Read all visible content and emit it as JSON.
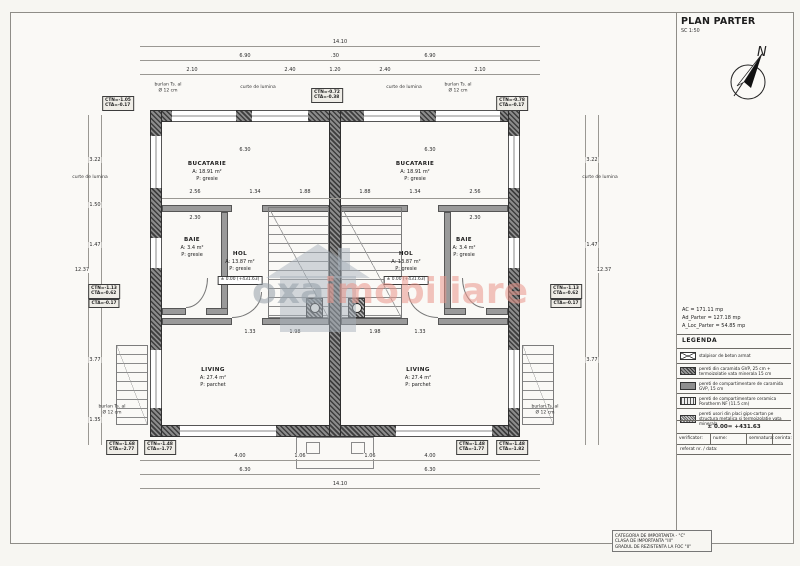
{
  "titleblock": {
    "title": "PLAN PARTER",
    "scale": "SC 1:50",
    "stats": [
      "AC = 171.11 mp",
      "Ad_Parter = 127.18 mp",
      "A_Loc_Parter = 54.85 mp"
    ],
    "legend_label": "LEGENDA",
    "legend": [
      {
        "swatch": "rc-column-hatch-icon",
        "desc": "stalpisor de beton armat"
      },
      {
        "swatch": "brick-wall-hatch-icon",
        "desc": "pereti din caramida GVP, 25 cm + termoizolatie vata minerala 15 cm"
      },
      {
        "swatch": "partition-wall-hatch-icon",
        "desc": "pereti de compartimentare de caramida GVP, 15 cm"
      },
      {
        "swatch": "porotherm-hatch-icon",
        "desc": "pereti de compartimentare ceramica Porotherm NF (11.5 cm)"
      },
      {
        "swatch": "drywall-hatch-icon",
        "desc": "pereti usori din placi gips-carton pe structura metalica si termoizolatie vata minerala"
      }
    ],
    "level_reference": "± 0.00= +431.63",
    "table_headers": [
      "verificator:",
      "nume:",
      "semnatura:",
      "cerinta:"
    ],
    "referat": "referat nr. / data:"
  },
  "notes_box": [
    "CATEGORIA DE IMPORTANTA - \"C\"",
    "CLASA DE IMPORTANTA \"III\"",
    "GRADUL DE REZISTENTA LA FOC \"II\""
  ],
  "watermark": {
    "gray": "oxa",
    "accent": "imobiliare",
    "accent_color": "#e9968b"
  },
  "plan": {
    "ext_walls": [
      [
        150,
        110,
        370,
        12
      ],
      [
        150,
        425,
        370,
        12
      ],
      [
        150,
        110,
        12,
        327
      ],
      [
        508,
        110,
        12,
        327
      ],
      [
        329,
        110,
        12,
        327
      ]
    ],
    "int_walls": [
      [
        162,
        205,
        70,
        7
      ],
      [
        262,
        205,
        67,
        7
      ],
      [
        341,
        205,
        67,
        7
      ],
      [
        438,
        205,
        70,
        7
      ],
      [
        221,
        212,
        7,
        103
      ],
      [
        162,
        308,
        24,
        7
      ],
      [
        206,
        308,
        22,
        7
      ],
      [
        444,
        212,
        7,
        103
      ],
      [
        444,
        308,
        22,
        7
      ],
      [
        486,
        308,
        22,
        7
      ],
      [
        162,
        318,
        70,
        7
      ],
      [
        262,
        318,
        67,
        7
      ],
      [
        341,
        318,
        67,
        7
      ],
      [
        438,
        318,
        70,
        7
      ]
    ],
    "windows_h": [
      [
        172,
        110,
        64,
        12
      ],
      [
        252,
        110,
        56,
        12
      ],
      [
        364,
        110,
        56,
        12
      ],
      [
        436,
        110,
        64,
        12
      ],
      [
        180,
        425,
        96,
        12
      ],
      [
        396,
        425,
        96,
        12
      ]
    ],
    "windows_v": [
      [
        150,
        136,
        12,
        52
      ],
      [
        150,
        238,
        12,
        30
      ],
      [
        150,
        350,
        12,
        58
      ],
      [
        508,
        136,
        12,
        52
      ],
      [
        508,
        238,
        12,
        30
      ],
      [
        508,
        350,
        12,
        58
      ]
    ],
    "stairs": [
      [
        268,
        207,
        61,
        111
      ],
      [
        341,
        207,
        61,
        111
      ]
    ],
    "ext_stairs": [
      [
        116,
        345,
        32,
        80
      ],
      [
        522,
        345,
        32,
        80
      ]
    ],
    "posts": [
      [
        306,
        298,
        17,
        20
      ],
      [
        348,
        298,
        17,
        20
      ]
    ],
    "boxes": [
      [
        296,
        437,
        78,
        32
      ],
      [
        306,
        442,
        14,
        12
      ],
      [
        351,
        442,
        14,
        12
      ]
    ],
    "arcs": [
      [
        186,
        278,
        22,
        30,
        "br"
      ],
      [
        462,
        278,
        22,
        30,
        "bl"
      ],
      [
        232,
        292,
        30,
        26,
        "br"
      ],
      [
        408,
        292,
        30,
        26,
        "bl"
      ]
    ],
    "dim_lines": [
      [
        140,
        46,
        400,
        1
      ],
      [
        140,
        60,
        400,
        1
      ],
      [
        140,
        74,
        400,
        1
      ],
      [
        140,
        460,
        400,
        1
      ],
      [
        140,
        474,
        400,
        1
      ],
      [
        140,
        488,
        400,
        1
      ],
      [
        88,
        115,
        1,
        330
      ],
      [
        101,
        115,
        1,
        330
      ],
      [
        585,
        115,
        1,
        330
      ],
      [
        598,
        115,
        1,
        330
      ],
      [
        162,
        198,
        346,
        1
      ]
    ],
    "dims": [
      [
        "14.10",
        340,
        42,
        0
      ],
      [
        "6.90",
        245,
        56,
        0
      ],
      [
        ".30",
        335,
        56,
        0
      ],
      [
        "6.90",
        430,
        56,
        0
      ],
      [
        "2.10",
        192,
        70,
        0
      ],
      [
        "2.40",
        290,
        70,
        0
      ],
      [
        "1.20",
        335,
        70,
        0
      ],
      [
        "2.40",
        385,
        70,
        0
      ],
      [
        "2.10",
        480,
        70,
        0
      ],
      [
        "6.30",
        245,
        150,
        0
      ],
      [
        "6.30",
        430,
        150,
        0
      ],
      [
        "2.56",
        195,
        192,
        0
      ],
      [
        "1.34",
        255,
        192,
        0
      ],
      [
        "1.88",
        305,
        192,
        0
      ],
      [
        "1.88",
        365,
        192,
        0
      ],
      [
        "1.34",
        415,
        192,
        0
      ],
      [
        "2.56",
        475,
        192,
        0
      ],
      [
        "2.30",
        195,
        218,
        0
      ],
      [
        "2.30",
        475,
        218,
        0
      ],
      [
        "1.33",
        250,
        332,
        0
      ],
      [
        "1.98",
        295,
        332,
        0
      ],
      [
        "1.98",
        375,
        332,
        0
      ],
      [
        "1.33",
        420,
        332,
        0
      ],
      [
        "4.00",
        240,
        456,
        0
      ],
      [
        "1.06",
        300,
        456,
        0
      ],
      [
        "1.06",
        370,
        456,
        0
      ],
      [
        "4.00",
        430,
        456,
        0
      ],
      [
        "6.30",
        245,
        470,
        0
      ],
      [
        "6.30",
        430,
        470,
        0
      ],
      [
        "14.10",
        340,
        484,
        0
      ],
      [
        "12.37",
        82,
        270,
        -90
      ],
      [
        "3.22",
        95,
        160,
        -90
      ],
      [
        "1.50",
        95,
        205,
        -90
      ],
      [
        "1.47",
        95,
        245,
        -90
      ],
      [
        "3.77",
        95,
        360,
        -90
      ],
      [
        "1.35",
        95,
        420,
        -90
      ],
      [
        "12.37",
        604,
        270,
        90
      ],
      [
        "3.22",
        592,
        160,
        90
      ],
      [
        "1.47",
        592,
        245,
        90
      ],
      [
        "3.77",
        592,
        360,
        90
      ]
    ],
    "rooms": [
      {
        "name": "BUCATARIE",
        "area": "A: 18.91 m²",
        "floor": "P:  gresie",
        "x": 207,
        "y": 160
      },
      {
        "name": "BUCATARIE",
        "area": "A: 18.91 m²",
        "floor": "P:  gresie",
        "x": 415,
        "y": 160
      },
      {
        "name": "BAIE",
        "area": "A: 3.4 m²",
        "floor": "P: gresie",
        "x": 192,
        "y": 236
      },
      {
        "name": "BAIE",
        "area": "A: 3.4 m²",
        "floor": "P: gresie",
        "x": 464,
        "y": 236
      },
      {
        "name": "HOL",
        "area": "A: 13.87 m²",
        "floor": "P:  gresie",
        "x": 240,
        "y": 250,
        "level": "± 0.00 (+431.63)"
      },
      {
        "name": "HOL",
        "area": "A: 13.87 m²",
        "floor": "P:  gresie",
        "x": 406,
        "y": 250,
        "level": "± 0.00 (+431.63)"
      },
      {
        "name": "LIVING",
        "area": "A: 27.4 m²",
        "floor": "P:  parchet",
        "x": 213,
        "y": 366
      },
      {
        "name": "LIVING",
        "area": "A: 27.4 m²",
        "floor": "P:  parchet",
        "x": 418,
        "y": 366
      }
    ],
    "marks": [
      {
        "x": 118,
        "y": 96,
        "lines": [
          "CTN=-1.05",
          "CTA=-0.17"
        ]
      },
      {
        "x": 327,
        "y": 88,
        "lines": [
          "CTN=-0.72",
          "CTA=-0.38"
        ]
      },
      {
        "x": 512,
        "y": 96,
        "lines": [
          "CTN=-0.78",
          "CTA=-0.17"
        ]
      },
      {
        "x": 104,
        "y": 284,
        "lines": [
          "CTN=-1.13",
          "CTA=-0.62"
        ]
      },
      {
        "x": 104,
        "y": 299,
        "lines": [
          "CTA=-0.17"
        ]
      },
      {
        "x": 566,
        "y": 284,
        "lines": [
          "CTN=-1.13",
          "CTA=-0.62"
        ]
      },
      {
        "x": 566,
        "y": 299,
        "lines": [
          "CTA=-0.17"
        ]
      },
      {
        "x": 122,
        "y": 440,
        "lines": [
          "CTN=-1.68",
          "CTA=-2.77"
        ]
      },
      {
        "x": 160,
        "y": 440,
        "lines": [
          "CTN=-1.48",
          "CTA=-1.77"
        ]
      },
      {
        "x": 472,
        "y": 440,
        "lines": [
          "CTN=-1.48",
          "CTA=-1.77"
        ]
      },
      {
        "x": 512,
        "y": 440,
        "lines": [
          "CTN=-1.48",
          "CTA=-1.82"
        ]
      }
    ],
    "notes": [
      {
        "t": "burlan Ts. al\nØ 12 cm",
        "x": 168,
        "y": 88
      },
      {
        "t": "burlan Ts. al\nØ 12 cm",
        "x": 458,
        "y": 88
      },
      {
        "t": "burlan Ts. al\nØ 12 cm",
        "x": 112,
        "y": 410
      },
      {
        "t": "burlan Ts. al\nØ 12 cm",
        "x": 545,
        "y": 410
      },
      {
        "t": "curte de lumina",
        "x": 258,
        "y": 88
      },
      {
        "t": "curte de lumina",
        "x": 404,
        "y": 88
      },
      {
        "t": "curte de lumina",
        "x": 90,
        "y": 178,
        "r": -90
      },
      {
        "t": "curte de lumina",
        "x": 600,
        "y": 178,
        "r": 90
      }
    ]
  }
}
